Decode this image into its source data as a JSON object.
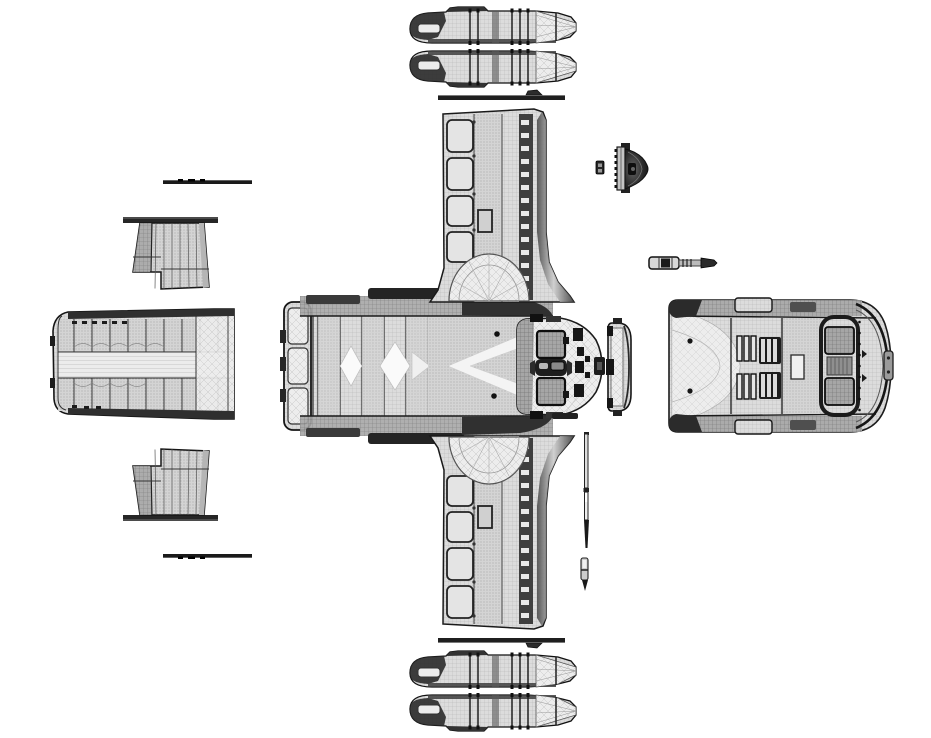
{
  "canvas": {
    "width": 931,
    "height": 738,
    "background": "#ffffff"
  },
  "palette": {
    "paper": "#ffffff",
    "outline": "#1a1a1a",
    "dark": "#262626",
    "mid": "#8a8a8a",
    "mesh": "#dcdcdc",
    "mesh_line": "#b2b2b2"
  },
  "sheet": {
    "kind": "monochrome wireframe exploded-view model sheet of a spacecraft",
    "text_labels": [],
    "symmetry": "upper and lower part rows mirrored about horizontal center"
  },
  "parts": {
    "upper_row": "upper mirrored parts row",
    "lower_row": "lower mirrored parts row",
    "nacelle": "engine nacelle side view",
    "spar_bar": "wing spar trim strip",
    "door_bar": "hatch trim strip",
    "hatch_panel": "side hatch panel",
    "cargo_ramp": "cargo ramp door panel",
    "hull_top": "main hull top view",
    "wing": "wing top view with armor panels",
    "intake": "engine intake fairing",
    "bow_view": "bow front view with cockpit windows",
    "canopy_section": "nose canopy ring section",
    "aft_view": "aft hull view with thruster cage",
    "sensor_dome": "sensor dome side view",
    "junction_block": "small junction block",
    "equipment_rod": "equipment rod / actuator",
    "antenna_mast": "antenna mast",
    "antenna_pin": "antenna pin"
  }
}
